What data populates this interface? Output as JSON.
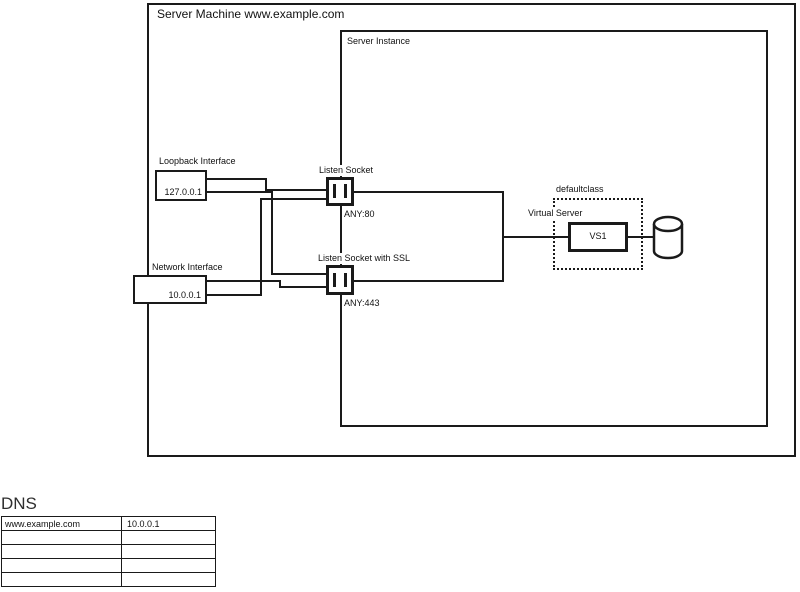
{
  "diagram": {
    "machine": {
      "title": "Server Machine www.example.com"
    },
    "instance": {
      "title": "Server Instance"
    },
    "loopback": {
      "label": "Loopback Interface",
      "address": "127.0.0.1"
    },
    "network": {
      "label": "Network Interface",
      "address": "10.0.0.1"
    },
    "listen_socket": {
      "label": "Listen Socket",
      "binding": "ANY:80"
    },
    "listen_socket_ssl": {
      "label": "Listen Socket with SSL",
      "binding": "ANY:443"
    },
    "default_class": {
      "label": "defaultclass"
    },
    "virtual_server": {
      "label": "Virtual Server",
      "name": "VS1"
    },
    "icons": {
      "socket": "socket-plug-icon",
      "database": "database-cylinder-icon"
    },
    "colors": {
      "line": "#1a1a1a",
      "text": "#111111",
      "heading": "#2f2f2f",
      "background": "#ffffff"
    }
  },
  "dns_table": {
    "heading": "DNS",
    "rows": [
      [
        "www.example.com",
        "10.0.0.1"
      ],
      [
        "",
        ""
      ],
      [
        "",
        ""
      ],
      [
        "",
        ""
      ],
      [
        "",
        ""
      ]
    ]
  }
}
